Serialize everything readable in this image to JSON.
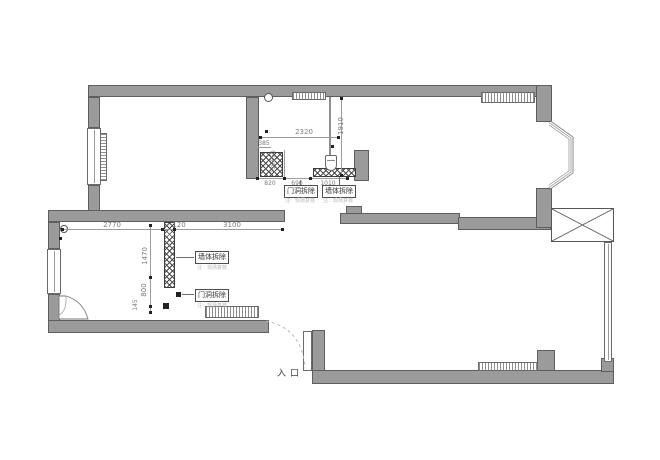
{
  "drawing": {
    "type": "floor-plan-demolition",
    "labels": {
      "entrance": "入口",
      "door_demolish": "门洞拆除",
      "wall_demolish": "墙体拆除",
      "note": "注：现场复核"
    },
    "dims": {
      "d2320": "2320",
      "d1910": "1910",
      "d385": "385",
      "d550": "550",
      "d130": "130",
      "d820": "820",
      "d690": "690",
      "d1010": "1010",
      "d2770": "2770",
      "d120": "120",
      "d3100": "3100",
      "d1470": "1470",
      "d800": "800",
      "d145": "145"
    },
    "colors": {
      "wall": "#9b9b9b",
      "wall_outline": "#5e5e5e",
      "demolish_hatch": "#4a4a4a",
      "dim_text": "#7d7d7d",
      "label_text": "#333333",
      "note_text": "#b8b8b8",
      "background": "#ffffff"
    }
  }
}
